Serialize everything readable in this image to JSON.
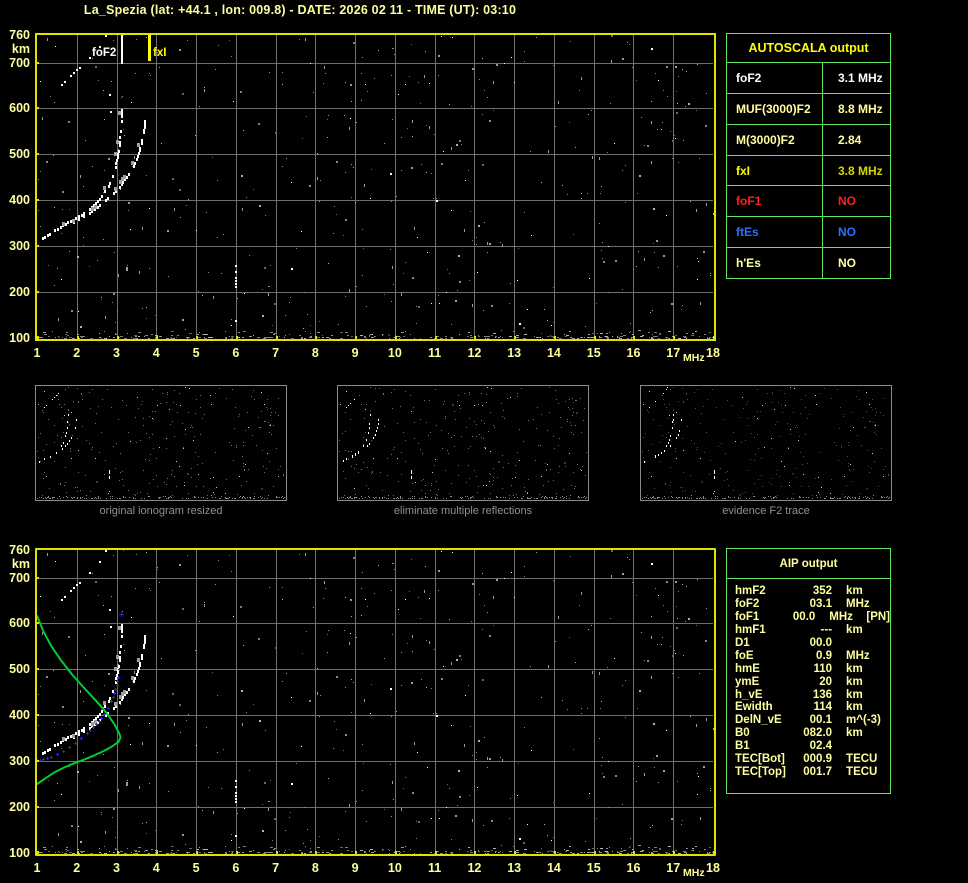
{
  "title": "La_Spezia (lat: +44.1 , lon: 009.8) - DATE: 2026 02 11 - TIME (UT): 03:10",
  "colors": {
    "pale_yellow": "#ffff9e",
    "bright_yellow": "#ffff00",
    "dark_yellow": "#d6d600",
    "plot_border": "#e2e200",
    "grid": "#6f6f6f",
    "table_border": "#5fe65f",
    "red": "#ff1f1f",
    "blue": "#2b6fff",
    "trace_white": "#ffffff",
    "profile_green": "#00cc33",
    "fitted_blue": "#2222ff",
    "caption_gray": "#909090"
  },
  "autoscala": {
    "header": "AUTOSCALA output",
    "rows": [
      {
        "param": "foF2",
        "value": "3.1 MHz",
        "param_color": "#ffffff",
        "value_color": "#ffffff"
      },
      {
        "param": "MUF(3000)F2",
        "value": "8.8 MHz",
        "param_color": "#ffff9e",
        "value_color": "#ffff9e"
      },
      {
        "param": "M(3000)F2",
        "value": "2.84",
        "param_color": "#ffff9e",
        "value_color": "#ffff9e"
      },
      {
        "param": "fxI",
        "value": "3.8 MHz",
        "param_color": "#ffff00",
        "value_color": "#d6d600"
      },
      {
        "param": "foF1",
        "value": "NO",
        "param_color": "#ff1f1f",
        "value_color": "#ff1f1f"
      },
      {
        "param": "ftEs",
        "value": "NO",
        "param_color": "#2b6fff",
        "value_color": "#2b6fff"
      },
      {
        "param": "h'Es",
        "value": "NO",
        "param_color": "#ffff9e",
        "value_color": "#ffff9e"
      }
    ]
  },
  "aip": {
    "header": "AIP output",
    "rows": [
      {
        "name": "hmF2",
        "value": "352",
        "unit": "km",
        "extra": ""
      },
      {
        "name": "foF2",
        "value": "03.1",
        "unit": "MHz",
        "extra": ""
      },
      {
        "name": "foF1",
        "value": "00.0",
        "unit": "MHz",
        "extra": "[PN]"
      },
      {
        "name": "hmF1",
        "value": "---",
        "unit": "km",
        "extra": ""
      },
      {
        "name": "D1",
        "value": "00.0",
        "unit": "",
        "extra": ""
      },
      {
        "name": "foE",
        "value": "0.9",
        "unit": "MHz",
        "extra": ""
      },
      {
        "name": "hmE",
        "value": "110",
        "unit": "km",
        "extra": ""
      },
      {
        "name": "ymE",
        "value": "20",
        "unit": "km",
        "extra": ""
      },
      {
        "name": "h_vE",
        "value": "136",
        "unit": "km",
        "extra": ""
      },
      {
        "name": "Ewidth",
        "value": "114",
        "unit": "km",
        "extra": ""
      },
      {
        "name": "DelN_vE",
        "value": "00.1",
        "unit": "m^(-3)",
        "extra": ""
      },
      {
        "name": "B0",
        "value": "082.0",
        "unit": "km",
        "extra": ""
      },
      {
        "name": "B1",
        "value": "02.4",
        "unit": "",
        "extra": ""
      },
      {
        "name": "TEC[Bot]",
        "value": "000.9",
        "unit": "TECU",
        "extra": ""
      },
      {
        "name": "TEC[Top]",
        "value": "001.7",
        "unit": "TECU",
        "extra": ""
      }
    ]
  },
  "panels": {
    "items": [
      {
        "caption": "original ionogram resized"
      },
      {
        "caption": "eliminate multiple reflections"
      },
      {
        "caption": "evidence F2 trace"
      }
    ]
  },
  "chart_data": [
    {
      "type": "scatter",
      "title": "autoscaled ionogram",
      "xlabel": "MHz",
      "ylabel": "km",
      "xlim": [
        1,
        18
      ],
      "ylim": [
        100,
        760
      ],
      "x_ticks": [
        1,
        2,
        3,
        4,
        5,
        6,
        7,
        8,
        9,
        10,
        11,
        12,
        13,
        14,
        15,
        16,
        17,
        18
      ],
      "y_ticks": [
        760,
        700,
        600,
        500,
        400,
        300,
        200,
        100
      ],
      "grid": "on",
      "markers": [
        {
          "label": "foF2",
          "freq_mhz": 3.1,
          "color": "#ffffff",
          "side": "left"
        },
        {
          "label": "fxI",
          "freq_mhz": 3.8,
          "color": "#ffff00",
          "side": "right"
        }
      ],
      "series": [
        {
          "name": "F2 ordinary trace",
          "points": [
            [
              1.12,
              318
            ],
            [
              1.3,
              327
            ],
            [
              1.5,
              338
            ],
            [
              1.7,
              349
            ],
            [
              1.9,
              358
            ],
            [
              2.1,
              368
            ],
            [
              2.3,
              381
            ],
            [
              2.5,
              398
            ],
            [
              2.65,
              415
            ],
            [
              2.78,
              432
            ],
            [
              2.88,
              452
            ],
            [
              2.95,
              473
            ],
            [
              3.0,
              495
            ],
            [
              3.05,
              520
            ],
            [
              3.08,
              545
            ],
            [
              3.1,
              572
            ],
            [
              3.12,
              597
            ]
          ]
        },
        {
          "name": "F2 extraordinary trace",
          "points": [
            [
              1.9,
              352
            ],
            [
              2.1,
              362
            ],
            [
              2.3,
              373
            ],
            [
              2.5,
              386
            ],
            [
              2.7,
              400
            ],
            [
              2.9,
              416
            ],
            [
              3.05,
              430
            ],
            [
              3.2,
              446
            ],
            [
              3.33,
              463
            ],
            [
              3.45,
              482
            ],
            [
              3.54,
              503
            ],
            [
              3.61,
              525
            ],
            [
              3.66,
              548
            ],
            [
              3.7,
              572
            ]
          ]
        },
        {
          "name": "second hop echo",
          "points": [
            [
              1.45,
              640
            ],
            [
              1.6,
              654
            ],
            [
              1.75,
              667
            ],
            [
              1.9,
              679
            ],
            [
              2.05,
              691
            ],
            [
              2.2,
              701
            ],
            [
              2.32,
              711
            ],
            [
              2.45,
              723
            ],
            [
              2.55,
              737
            ],
            [
              2.65,
              750
            ],
            [
              2.72,
              760
            ]
          ]
        },
        {
          "name": "interference streak",
          "points": [
            [
              5.98,
              207
            ],
            [
              5.98,
              232
            ],
            [
              5.98,
              240
            ],
            [
              5.98,
              266
            ]
          ]
        }
      ]
    },
    {
      "type": "scatter",
      "title": "ionogram with AIP profile",
      "xlabel": "MHz",
      "ylabel": "km",
      "xlim": [
        1,
        18
      ],
      "ylim": [
        100,
        760
      ],
      "x_ticks": [
        1,
        2,
        3,
        4,
        5,
        6,
        7,
        8,
        9,
        10,
        11,
        12,
        13,
        14,
        15,
        16,
        17,
        18
      ],
      "y_ticks": [
        760,
        700,
        600,
        500,
        400,
        300,
        200,
        100
      ],
      "grid": "on",
      "series": [
        {
          "name": "electron density profile",
          "color": "#00cc33",
          "points": [
            [
              1.0,
              617
            ],
            [
              1.15,
              585
            ],
            [
              1.35,
              552
            ],
            [
              1.6,
              520
            ],
            [
              1.9,
              487
            ],
            [
              2.2,
              458
            ],
            [
              2.5,
              430
            ],
            [
              2.75,
              405
            ],
            [
              2.95,
              380
            ],
            [
              3.07,
              360
            ],
            [
              3.1,
              352
            ],
            [
              3.05,
              342
            ],
            [
              2.9,
              333
            ],
            [
              2.7,
              323
            ],
            [
              2.45,
              313
            ],
            [
              2.2,
              304
            ],
            [
              1.95,
              296
            ],
            [
              1.7,
              287
            ],
            [
              1.45,
              276
            ],
            [
              1.25,
              265
            ],
            [
              1.1,
              256
            ],
            [
              1.0,
              250
            ]
          ]
        },
        {
          "name": "fitted F2 trace",
          "color": "#2222ff",
          "points": [
            [
              1.0,
              303
            ],
            [
              1.08,
              303
            ],
            [
              1.16,
              304
            ],
            [
              1.25,
              306
            ],
            [
              1.35,
              309
            ],
            [
              1.5,
              315
            ],
            [
              1.65,
              322
            ],
            [
              1.8,
              330
            ],
            [
              1.95,
              340
            ],
            [
              2.1,
              350
            ],
            [
              2.25,
              361
            ],
            [
              2.4,
              374
            ],
            [
              2.55,
              388
            ],
            [
              2.68,
              402
            ],
            [
              2.78,
              416
            ],
            [
              2.87,
              431
            ],
            [
              2.94,
              448
            ],
            [
              3.0,
              466
            ],
            [
              3.04,
              484
            ],
            [
              3.06,
              500
            ]
          ]
        },
        {
          "name": "hmF2 cross marker",
          "color": "#2222ff",
          "points": [
            [
              3.1,
              620
            ]
          ]
        }
      ]
    }
  ],
  "noise": {
    "seed": 97,
    "scatter_count": 430,
    "band_count": 280,
    "dash_count": 46
  }
}
